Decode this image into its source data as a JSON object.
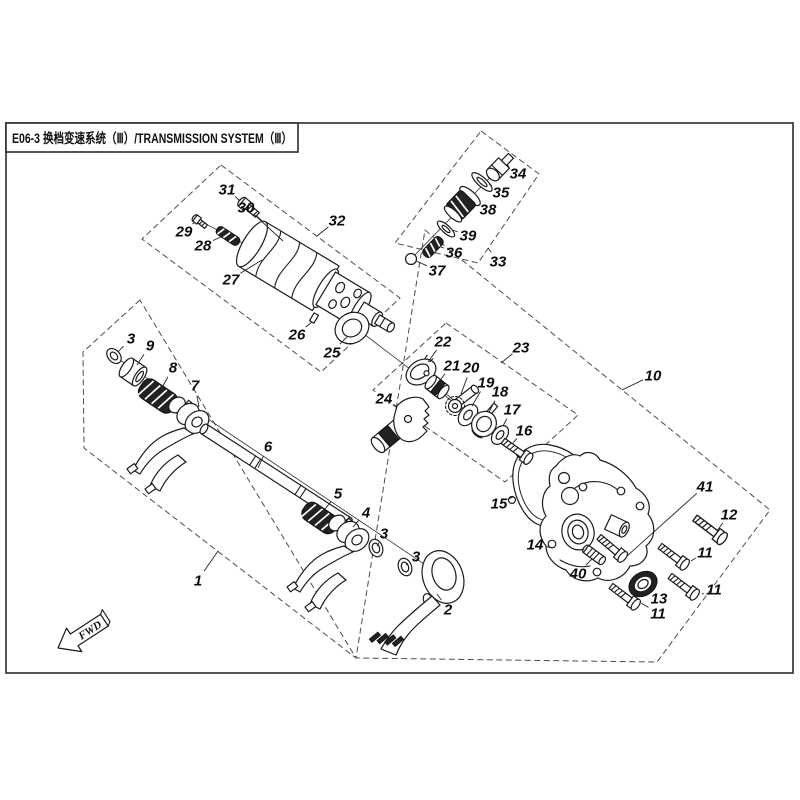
{
  "title": "E06-3 换档变速系统（Ⅲ）/TRANSMISSION SYSTEM（Ⅲ）",
  "fwd_label": "FWD",
  "boxes": [
    {
      "label": "1",
      "points": "140,300 83,352 84,448 356,658"
    },
    {
      "label": "10",
      "points": "425,230 770,510 657,662 356,658"
    },
    {
      "label": "23",
      "points": "446,323 578,415 505,482 373,390"
    },
    {
      "label": "32",
      "points": "221,165 400,298 321,372 142,239"
    },
    {
      "label": "33",
      "points": "481,131 539,174 478,263 395,243"
    }
  ],
  "callouts": [
    {
      "n": "1",
      "x": 198,
      "y": 580,
      "lx": 218,
      "ly": 551
    },
    {
      "n": "2",
      "x": 448,
      "y": 609,
      "lx": 437,
      "ly": 594
    },
    {
      "n": "3",
      "x": 131,
      "y": 338,
      "lx": 118,
      "ly": 352
    },
    {
      "n": "3",
      "x": 384,
      "y": 533,
      "lx": 377,
      "ly": 546
    },
    {
      "n": "3",
      "x": 416,
      "y": 556,
      "lx": 406,
      "ly": 565
    },
    {
      "n": "4",
      "x": 366,
      "y": 512,
      "lx": 353,
      "ly": 527
    },
    {
      "n": "5",
      "x": 338,
      "y": 493,
      "lx": 325,
      "ly": 509
    },
    {
      "n": "6",
      "x": 268,
      "y": 446,
      "lx": 258,
      "ly": 468
    },
    {
      "n": "7",
      "x": 195,
      "y": 385,
      "lx": 199,
      "ly": 407
    },
    {
      "n": "8",
      "x": 173,
      "y": 367,
      "lx": 163,
      "ly": 386
    },
    {
      "n": "9",
      "x": 150,
      "y": 345,
      "lx": 137,
      "ly": 365
    },
    {
      "n": "10",
      "x": 653,
      "y": 375,
      "lx": 622,
      "ly": 390
    },
    {
      "n": "11",
      "x": 658,
      "y": 613,
      "lx": 641,
      "ly": 603
    },
    {
      "n": "11",
      "x": 714,
      "y": 589,
      "lx": 702,
      "ly": 594
    },
    {
      "n": "11",
      "x": 705,
      "y": 552,
      "lx": 691,
      "ly": 561
    },
    {
      "n": "12",
      "x": 729,
      "y": 514,
      "lx": 717,
      "ly": 531
    },
    {
      "n": "13",
      "x": 659,
      "y": 598,
      "lx": 648,
      "ly": 589
    },
    {
      "n": "14",
      "x": 535,
      "y": 544,
      "lx": 553,
      "ly": 548
    },
    {
      "n": "15",
      "x": 499,
      "y": 503,
      "lx": 513,
      "ly": 497
    },
    {
      "n": "16",
      "x": 524,
      "y": 430,
      "lx": 513,
      "ly": 443
    },
    {
      "n": "17",
      "x": 512,
      "y": 409,
      "lx": 503,
      "ly": 426
    },
    {
      "n": "18",
      "x": 500,
      "y": 391,
      "lx": 489,
      "ly": 412
    },
    {
      "n": "19",
      "x": 486,
      "y": 382,
      "lx": 472,
      "ly": 406
    },
    {
      "n": "20",
      "x": 471,
      "y": 367,
      "lx": 461,
      "ly": 394
    },
    {
      "n": "21",
      "x": 452,
      "y": 365,
      "lx": 441,
      "ly": 379
    },
    {
      "n": "22",
      "x": 443,
      "y": 341,
      "lx": 428,
      "ly": 362
    },
    {
      "n": "23",
      "x": 521,
      "y": 347,
      "lx": 501,
      "ly": 363
    },
    {
      "n": "24",
      "x": 384,
      "y": 398,
      "lx": 396,
      "ly": 407
    },
    {
      "n": "25",
      "x": 332,
      "y": 352,
      "lx": 347,
      "ly": 337
    },
    {
      "n": "26",
      "x": 297,
      "y": 334,
      "lx": 312,
      "ly": 322
    },
    {
      "n": "27",
      "x": 231,
      "y": 279,
      "lx": 262,
      "ly": 260
    },
    {
      "n": "28",
      "x": 203,
      "y": 245,
      "lx": 223,
      "ly": 236
    },
    {
      "n": "29",
      "x": 184,
      "y": 231,
      "lx": 195,
      "ly": 222
    },
    {
      "n": "30",
      "x": 246,
      "y": 207,
      "lx": 283,
      "ly": 241
    },
    {
      "n": "31",
      "x": 227,
      "y": 189,
      "lx": 240,
      "ly": 201
    },
    {
      "n": "32",
      "x": 337,
      "y": 220,
      "lx": 317,
      "ly": 236
    },
    {
      "n": "33",
      "x": 498,
      "y": 261,
      "lx": 488,
      "ly": 248
    },
    {
      "n": "34",
      "x": 518,
      "y": 173,
      "lx": 507,
      "ly": 165
    },
    {
      "n": "35",
      "x": 501,
      "y": 192,
      "lx": 489,
      "ly": 184
    },
    {
      "n": "36",
      "x": 454,
      "y": 252,
      "lx": 441,
      "ly": 247
    },
    {
      "n": "37",
      "x": 437,
      "y": 270,
      "lx": 416,
      "ly": 261
    },
    {
      "n": "38",
      "x": 488,
      "y": 209,
      "lx": 474,
      "ly": 205
    },
    {
      "n": "39",
      "x": 468,
      "y": 235,
      "lx": 452,
      "ly": 230
    },
    {
      "n": "40",
      "x": 578,
      "y": 573,
      "lx": 592,
      "ly": 559
    },
    {
      "n": "41",
      "x": 705,
      "y": 486,
      "lx": 627,
      "ly": 556
    }
  ]
}
